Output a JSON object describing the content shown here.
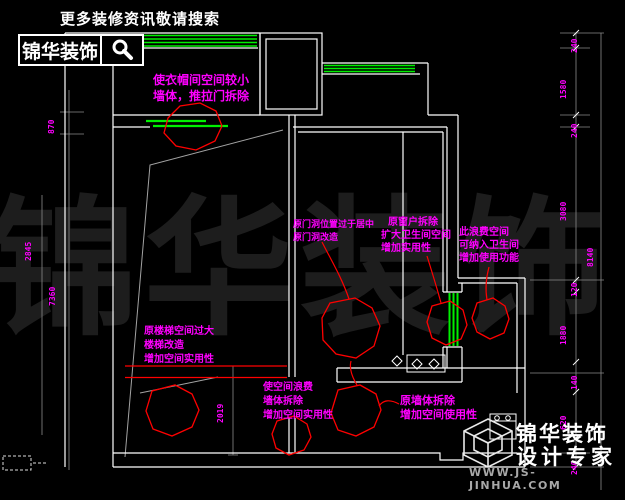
{
  "header": {
    "tagline": "更多装修资讯敬请搜索",
    "logo_text": "锦华装饰",
    "search_icon": "magnifier"
  },
  "watermark_text": "锦华装饰",
  "footer_logo": {
    "brand_line1": "锦华装饰",
    "brand_line2": "设计专家",
    "website": "WWW.JS-JINHUA.COM"
  },
  "palette": {
    "annotation": "#ff00ff",
    "revision_cloud": "#ff0000",
    "window": "#00f000",
    "wall_line": "#ffffff",
    "construction_line": "#a3a3a3",
    "background": "#000000"
  },
  "plan": {
    "annotations": [
      {
        "id": "closet",
        "lines": [
          "使衣帽间空间较小",
          "墙体，推拉门拆除"
        ]
      },
      {
        "id": "door-opening",
        "lines": [
          "原门洞位置过于居中",
          "原门洞改造"
        ]
      },
      {
        "id": "window-removal",
        "lines": [
          "原窗户拆除",
          "扩大卫生间空间",
          "增加实用性"
        ]
      },
      {
        "id": "wasted-space",
        "lines": [
          "此浪费空间",
          "可纳入卫生间",
          "增加使用功能"
        ]
      },
      {
        "id": "stair",
        "lines": [
          "原楼梯空间过大",
          "楼梯改造",
          "增加空间实用性"
        ]
      },
      {
        "id": "wall-center",
        "lines": [
          "使空间浪费",
          "墙体拆除",
          "增加空间实用性"
        ]
      },
      {
        "id": "wall-right",
        "lines": [
          "原墙体拆除",
          "增加空间使用性"
        ]
      }
    ],
    "dimensions": {
      "right": [
        "240",
        "1580",
        "240",
        "3080",
        "120",
        "1880",
        "140",
        "620",
        "240"
      ],
      "right_total": "8140",
      "left": [
        "870",
        "2845",
        "7360"
      ],
      "inner": "2019",
      "stray": "2"
    }
  }
}
